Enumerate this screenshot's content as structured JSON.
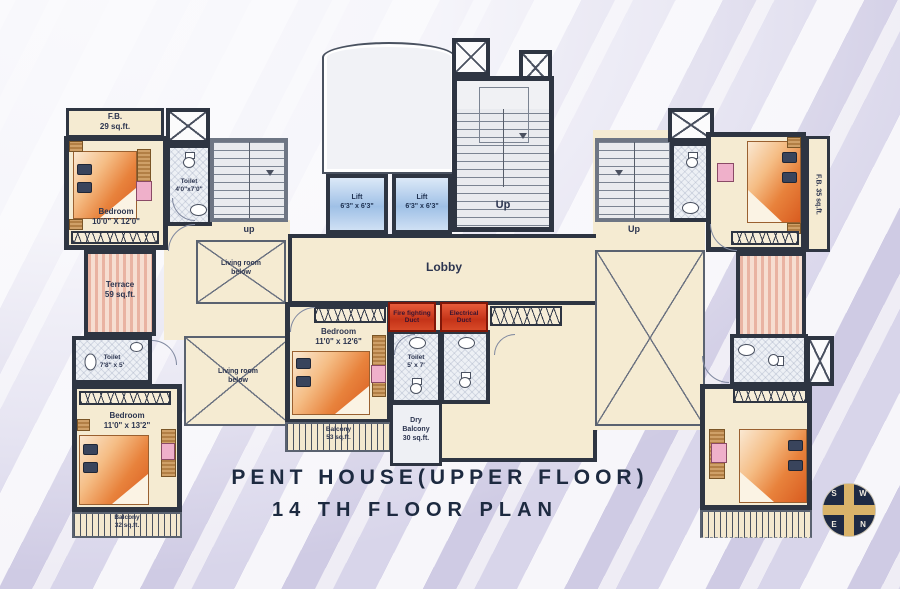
{
  "title": {
    "line1": "PENT HOUSE(UPPER FLOOR)",
    "line2": "14 TH FLOOR PLAN"
  },
  "compass": {
    "s": "S",
    "w": "W",
    "e": "E",
    "n": "N"
  },
  "labels": {
    "up_left": "up",
    "up_center": "Up",
    "up_right": "Up",
    "lobby": "Lobby"
  },
  "rooms": {
    "fb_left": {
      "name": "F.B.",
      "area": "29 sq.ft."
    },
    "bedroom_top_left": {
      "name": "Bedroom",
      "size": "10'0\" X 12'0\""
    },
    "toilet_top_left": {
      "name": "Toilet",
      "size": "4'0\"x7'0\""
    },
    "living_room_left_upper": {
      "name": "Living room",
      "note": "below"
    },
    "living_room_left_lower": {
      "name": "Living room",
      "note": "below"
    },
    "terrace_left": {
      "name": "Terrace",
      "area": "59 sq.ft."
    },
    "toilet_mid_left": {
      "name": "Toilet",
      "size": "7'8\" x 5'"
    },
    "bedroom_bottom_left": {
      "name": "Bedroom",
      "size": "11'0\" x 13'2\""
    },
    "balcony_bottom_left": {
      "name": "Balcony",
      "area": "32 sq.ft."
    },
    "lift_1": {
      "name": "Lift",
      "size": "6'3\" x 6'3\""
    },
    "lift_2": {
      "name": "Lift",
      "size": "6'3\" x 6'3\""
    },
    "fire_duct": {
      "name": "Fire fighting",
      "note": "Duct"
    },
    "electrical_duct": {
      "name": "Electrical",
      "note": "Duct"
    },
    "bedroom_center": {
      "name": "Bedroom",
      "size": "11'0\" x 12'6\""
    },
    "balcony_center": {
      "name": "Balcony",
      "area": "53 sq.ft."
    },
    "toilet_center": {
      "name": "Toilet",
      "size": "5' x 7'"
    },
    "dry_balcony": {
      "name": "Dry",
      "name2": "Balcony",
      "area": "30 sq.ft."
    },
    "fb_right": {
      "label": "F.B. 35 sq.ft."
    }
  },
  "colors": {
    "wall": "#2e3542",
    "room_fill": "#f4e9cf",
    "duct_red": "#c9381f",
    "lift_blue": "#b9d0ec",
    "bed_orange": "#e06a28",
    "stripe_lavender": "#cdc9e2",
    "title_navy": "#1d2a40"
  }
}
